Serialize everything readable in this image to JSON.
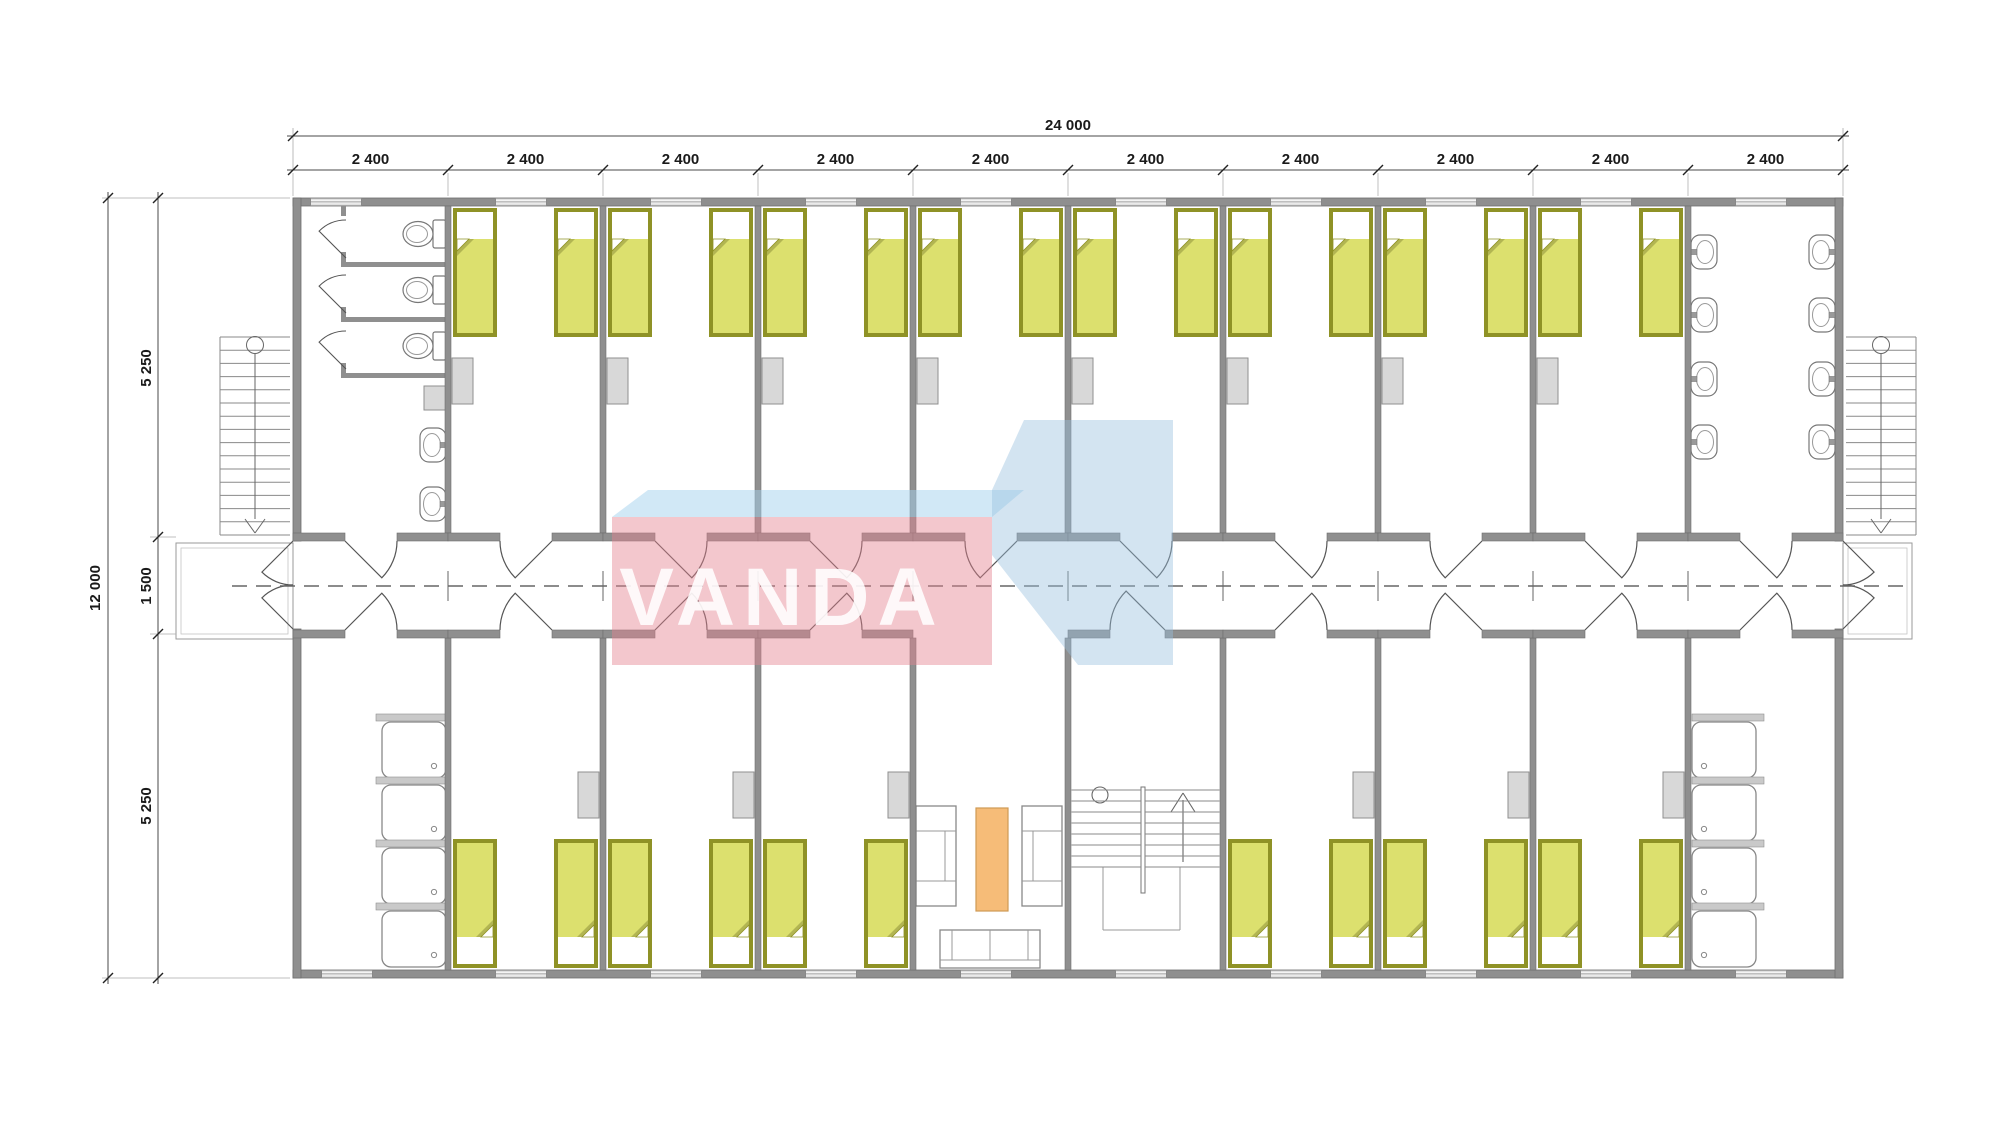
{
  "drawing": {
    "type": "architectural-floor-plan",
    "watermark": {
      "text": "VANDA"
    },
    "dimensions": {
      "total_width": "24 000",
      "module_width": "2 400",
      "total_height": "12 000",
      "upper_depth": "5 250",
      "corridor_width": "1 500",
      "lower_depth": "5 250"
    },
    "colors": {
      "wall": "#8f8f8f",
      "wall_edge": "#6e6e6e",
      "bed_frame": "#8f9226",
      "bed_blanket": "#dce06e",
      "bed_fold": "#b2b552",
      "cabinet": "#d8d8d8",
      "cabinet_edge": "#8f8f8f",
      "table_orange": "#f6bc78",
      "table_edge": "#cf9a55",
      "fixture_line": "#777777",
      "thin_line": "#9a9a9a",
      "dim_line": "#4a4a4a",
      "dim_text": "#1a1a1a",
      "centerline": "#666666",
      "watermark_pink": "rgba(228,130,145,0.45)",
      "watermark_band_blue": "rgba(164,209,238,0.50)",
      "watermark_steel_blue": "rgba(150,190,222,0.42)",
      "watermark_text_color": "rgba(255,255,255,0.88)"
    }
  }
}
